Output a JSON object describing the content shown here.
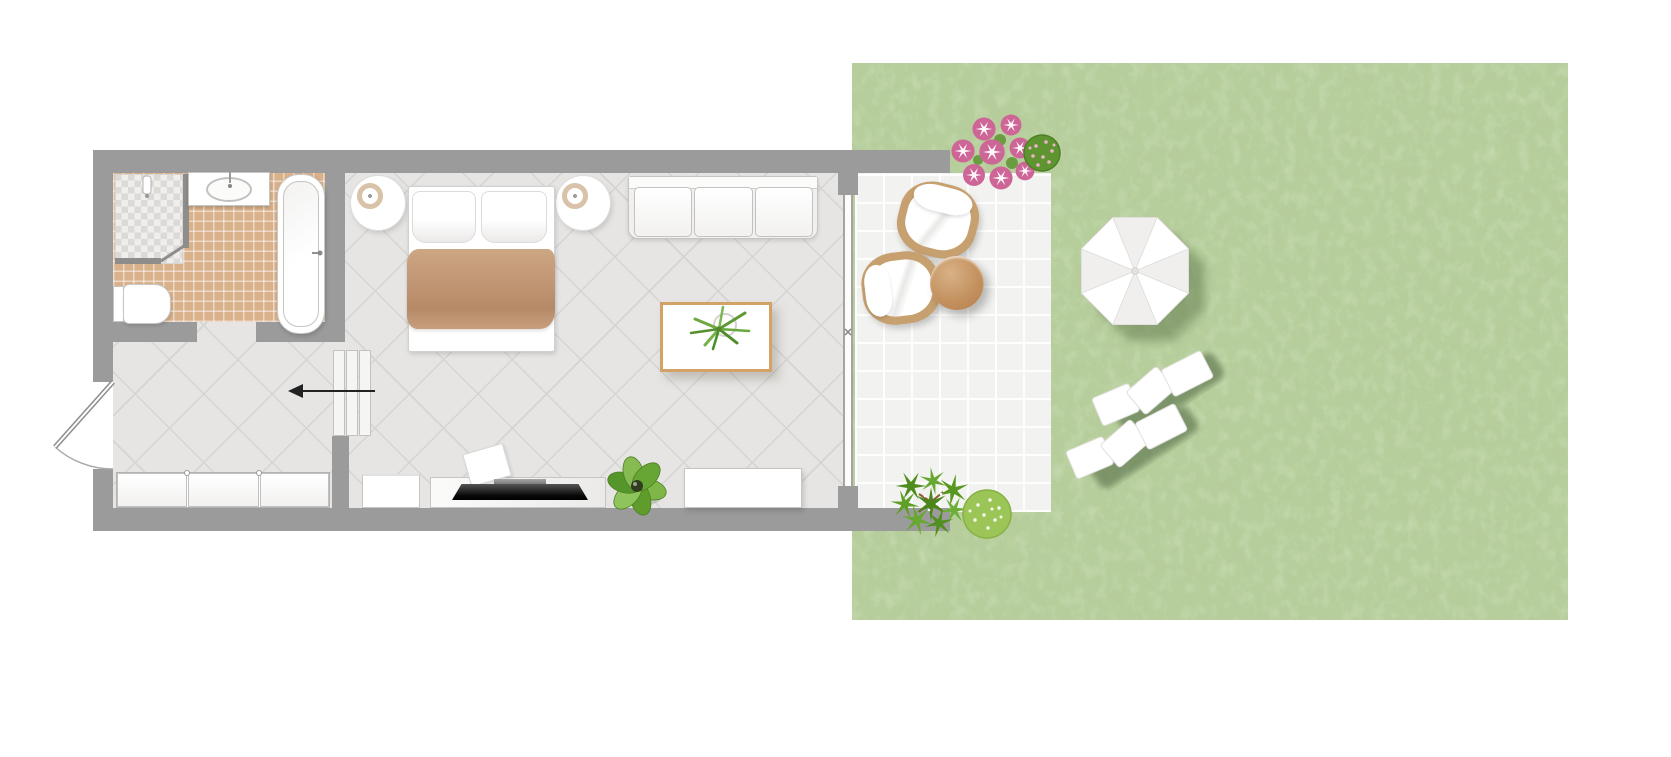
{
  "meta": {
    "type": "floor-plan",
    "description": "Top-down floor plan of a studio room with bathroom, entry hall, combined bedroom and living room, tiled terrace and lawn garden",
    "visible_text": ""
  },
  "colors": {
    "wall": "#9b9b9b",
    "room_floor": "#e6e5e3",
    "room_tile_line": "#d5d4d2",
    "bathroom_tile": "#d9b18b",
    "terrace_tile": "#f2f2f0",
    "grass": "#b6ce9b",
    "grass_shade": "#7f9e63",
    "furniture_white": "#ffffff",
    "furniture_outline": "#c6c5c4",
    "blanket_tan": "#c09573",
    "wood_trim": "#d2a267",
    "wicker_tan": "#c7a06f",
    "table_brown": "#c28f5d",
    "flower_pink": "#cd6697",
    "bush_green": "#579422",
    "bush_light": "#9cc558",
    "tv_black": "#111111",
    "arrow_black": "#222222"
  },
  "rooms": [
    {
      "name": "Bathroom",
      "floor": "terracotta tiles",
      "items": [
        "shower with mosaic tray",
        "washbasin on counter",
        "bathtub",
        "toilet"
      ]
    },
    {
      "name": "Entry hall",
      "floor": "diagonal stone tiles",
      "items": [
        "entry door with swing arc",
        "built-in wardrobe with three doors",
        "three steps",
        "entry direction arrow"
      ]
    },
    {
      "name": "Bedroom and living room",
      "floor": "diagonal stone tiles",
      "items": [
        "double bed with tan blanket and two pillows",
        "two round bedside tables with lamps",
        "three-seat sofa",
        "coffee table with green plant",
        "TV lowboard with flat TV",
        "small cabinet",
        "sideboard",
        "potted plant"
      ]
    },
    {
      "name": "Terrace",
      "floor": "light square tiles",
      "items": [
        "two wicker armchairs with white cushions",
        "round wooden side table",
        "pink flower bush",
        "green shrubs"
      ]
    },
    {
      "name": "Garden",
      "floor": "lawn",
      "items": [
        "white parasol",
        "two sun loungers"
      ]
    }
  ]
}
